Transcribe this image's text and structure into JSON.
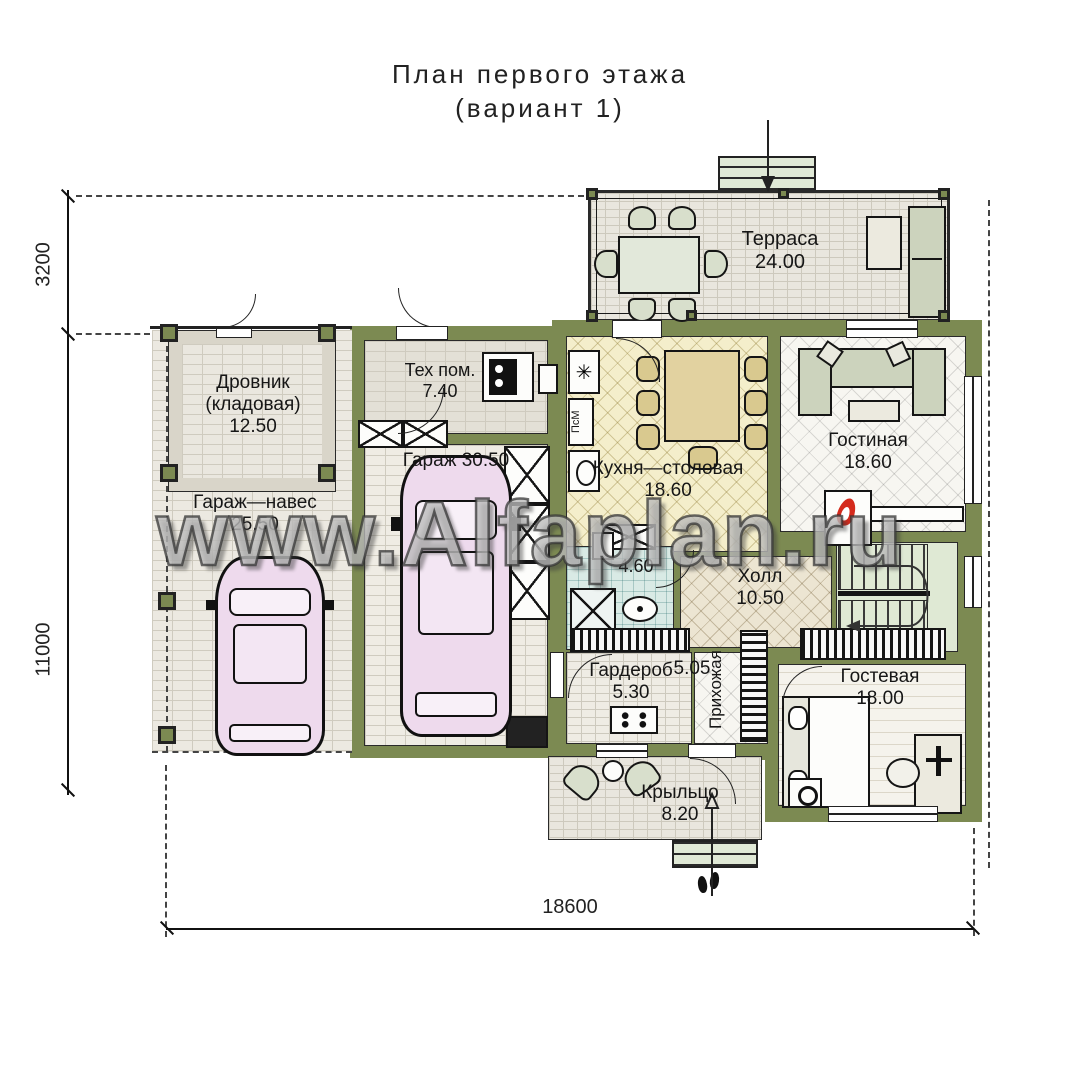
{
  "title": {
    "line1": "План первого этажа",
    "line2": "(вариант 1)"
  },
  "watermark": "www.Alfaplan.ru",
  "dimensions": {
    "left_top": "3200",
    "left_bottom": "11000",
    "bottom": "18600"
  },
  "rooms": {
    "terrace": {
      "name": "Терраса",
      "area": "24.00"
    },
    "woodshed": {
      "name": "Дровник",
      "subname": "(кладовая)",
      "area": "12.50"
    },
    "carport": {
      "name": "Гараж—навес",
      "area": "25.50"
    },
    "tech": {
      "name": "Тех пом.",
      "area": "7.40"
    },
    "garage": {
      "name": "Гараж",
      "area": "30.50"
    },
    "kitchen": {
      "name": "Кухня—столовая",
      "area": "18.60"
    },
    "living": {
      "name": "Гостиная",
      "area": "18.60"
    },
    "hall": {
      "name": "Холл",
      "area": "10.50"
    },
    "bathroom": {
      "area": "4.60"
    },
    "wardrobe": {
      "name": "Гардероб",
      "area": "5.30"
    },
    "entry": {
      "name": "Прихожая",
      "area": "5.05"
    },
    "guest": {
      "name": "Гостевая",
      "area": "18.00"
    },
    "porch": {
      "name": "Крыльцо",
      "area": "8.20"
    }
  },
  "labels": {
    "dishwasher": "ПсМ"
  },
  "icons": {
    "fridge": "✳"
  },
  "colors": {
    "wall": "#7c8a52",
    "kitchen_floor": "#f4eecb",
    "stairs_floor": "#dfe9d4",
    "bath_floor": "#d9eae5",
    "car": "#eedaed",
    "flame": "#d42a1c"
  }
}
